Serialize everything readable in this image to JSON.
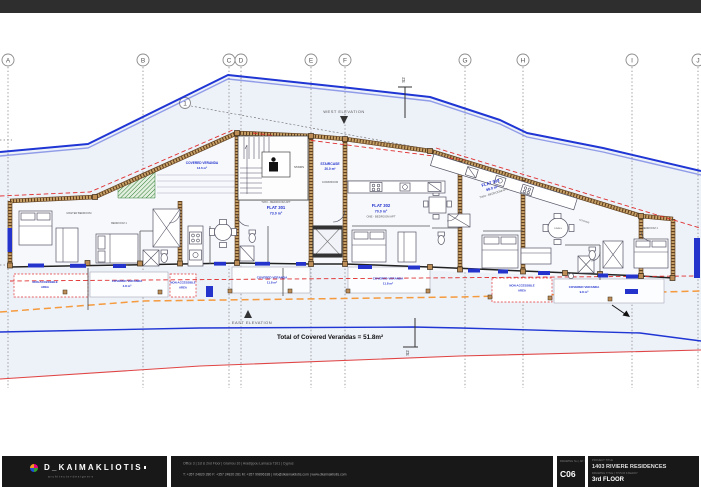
{
  "colors": {
    "boundary_blue": "#1f35d4",
    "accent_blue": "#2433cc",
    "wall_tan": "#c9a268",
    "wall_dark": "#5f3f1f",
    "red_line": "#e04545",
    "orange_dash": "#f59a3d",
    "green_hatch": "#2e7d32"
  },
  "grid": {
    "columns": [
      "A",
      "B",
      "C",
      "D",
      "E",
      "F",
      "G",
      "H",
      "I",
      "J"
    ],
    "row": "1"
  },
  "plan": {
    "west_elevation": "WEST ELEVATION",
    "east_elevation": "EAST ELEVATION",
    "section_marker": "S2",
    "total_note": "Total of Covered Verandas = 51.8m²",
    "staircase": {
      "name": "STAIRCASE",
      "area": "20.0 m²"
    },
    "corridor": "CORRIDOR",
    "stairs": "STAIRS",
    "flats": [
      {
        "name": "FLAT 301",
        "area": "73.0 m²",
        "type": "TWO - BEDROOM APT"
      },
      {
        "name": "FLAT 302",
        "area": "70.0 m²",
        "type": "ONE - BEDROOM APT"
      },
      {
        "name": "FLAT 303",
        "area": "98.0 m²",
        "type": "TWO - BEDROOM APT"
      }
    ],
    "verandas": [
      {
        "label": "COVERED VERANDA",
        "area": "13.6 m²"
      },
      {
        "label": "COVERED VERANDA",
        "area": "4.8 m²"
      },
      {
        "label": "COVERED VERANDA",
        "area": "11.8 m²"
      },
      {
        "label": "COVERED VERANDA",
        "area": "11.8 m²"
      },
      {
        "label": "COVERED VERANDA",
        "area": "9.8 m²"
      }
    ],
    "non_accessible": {
      "line1": "NON-ACCESSIBLE",
      "line2": "AREA"
    },
    "rooms": {
      "master_bedroom": "MASTER BEDROOM",
      "bedroom1_left": "BEDROOM 1",
      "bedroom1_right": "BEDROOM 1",
      "kitchen": "KITCHEN",
      "dining": "DINING"
    }
  },
  "titleblock": {
    "brand": "D_KAIMAKLIOTIS",
    "brand_sub": "architects+designers",
    "address": "Office 3 | 1st & 2nd Floor | Gramou 10 | Aradippou Larnaca 7101 | Cyprus",
    "contact": "T: +357 24820 280   F: +357 24820 281   M: +357 99896188 | info@dkaimakliotis.com | www.dkaimakliotis.com",
    "drawing_no_label": "DRAWING No | ΑΡ. ΣΧΕΔΙΟΥ",
    "drawing_no": "C06",
    "project_label": "PROJECT TITLE",
    "project_name": "1403 RIVIERE RESIDENCES",
    "sheet_label": "DRAWING TITLE | ΤΙΤΛΟΣ ΣΧΕΔΙΟΥ",
    "sheet_name": "3rd FLOOR"
  }
}
